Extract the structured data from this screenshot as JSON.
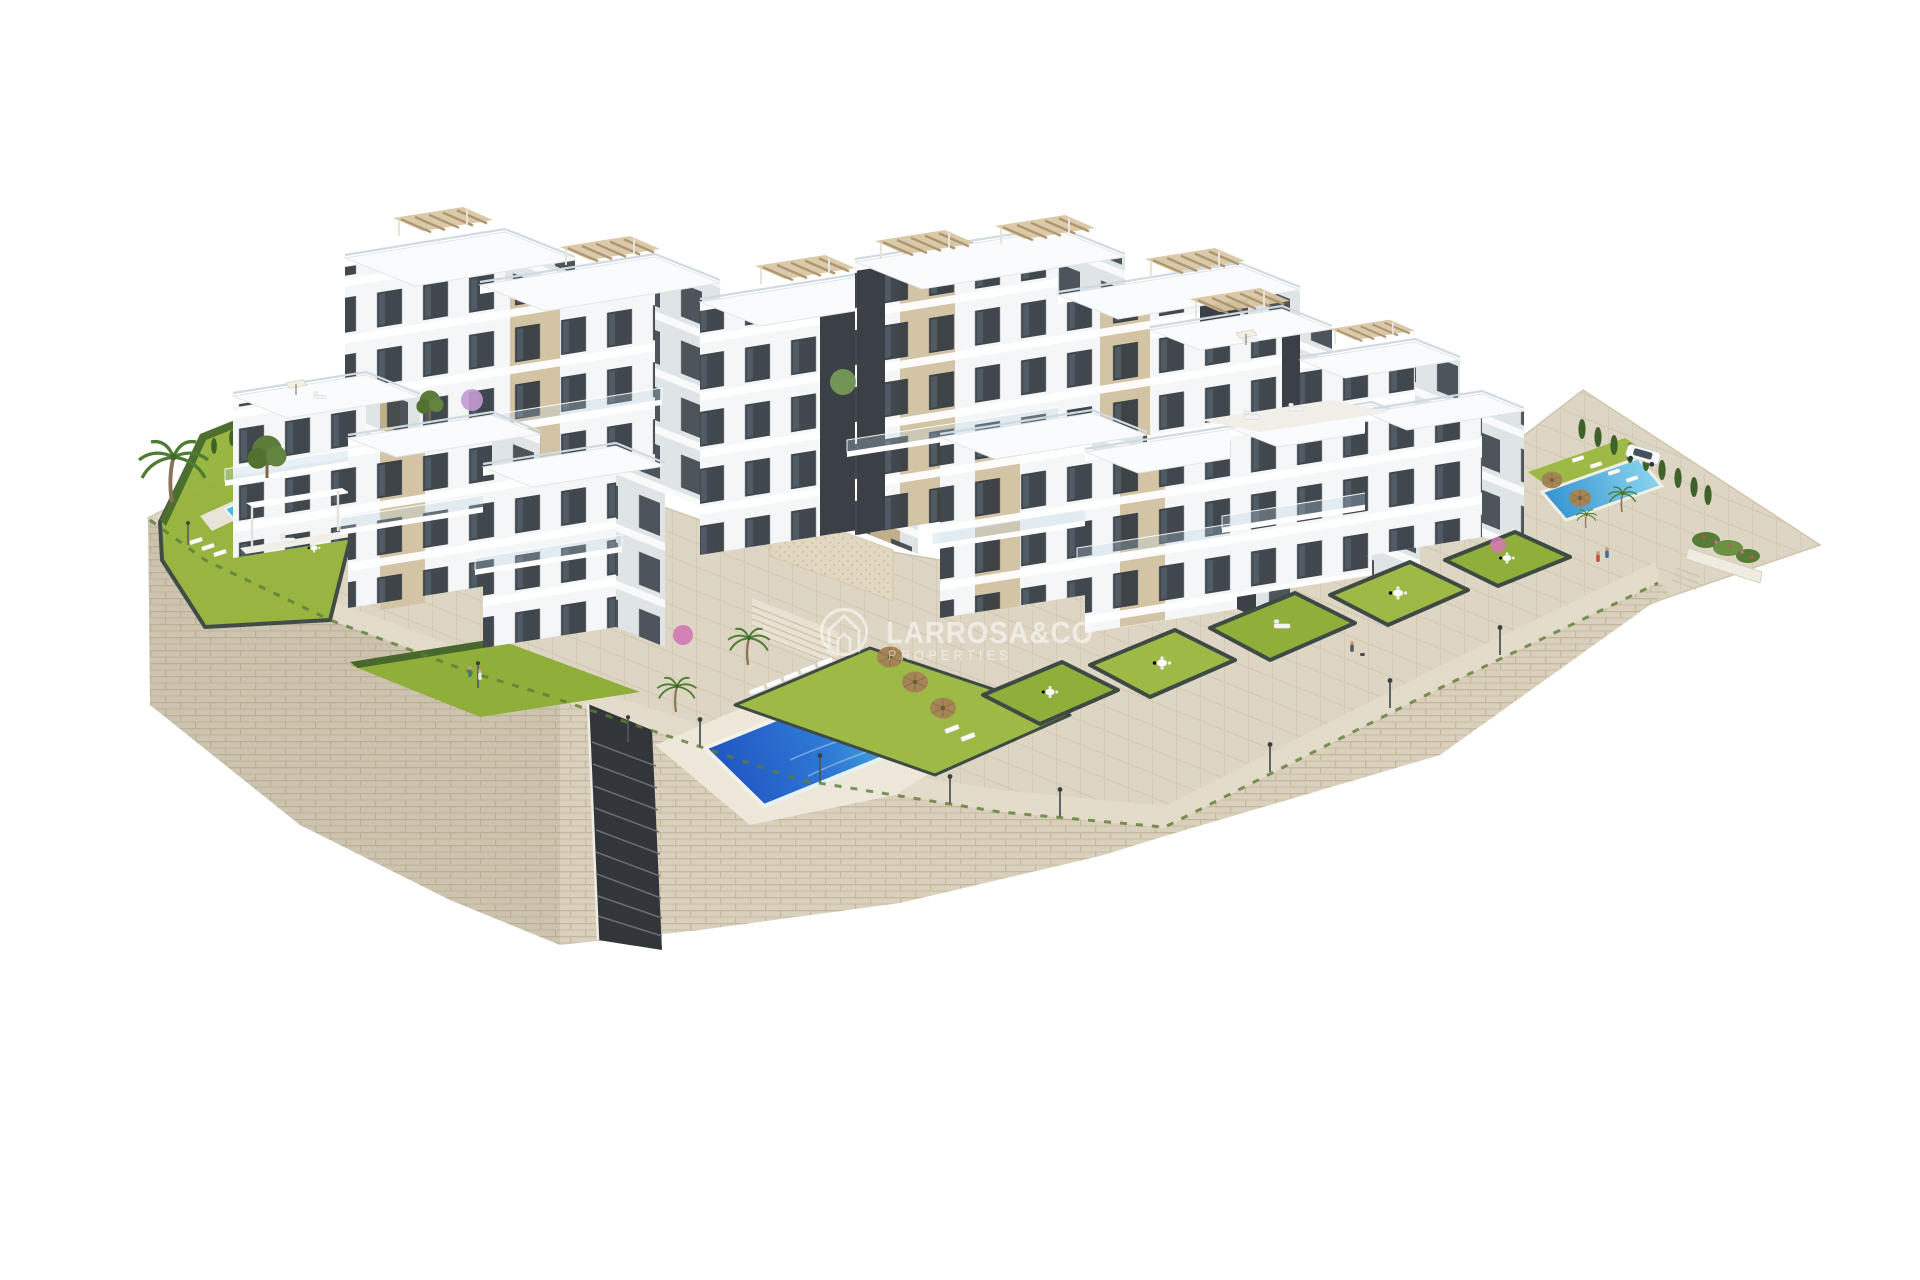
{
  "meta": {
    "description": "Aerial 3D architectural render of a hillside residential complex: white apartment blocks with tan accents and rooftop pergolas, terraced private gardens, three swimming pools, palm trees and travertine stone retaining walls on a pure white background"
  },
  "watermark": {
    "brand": "LARROSA&CO",
    "tagline": "PROPERTIES",
    "logo": "house-in-circle-icon",
    "color": "#ffffff"
  },
  "palette": {
    "background": "#ffffff",
    "building_front": "#f4f6f7",
    "building_side": "#dfe4e7",
    "roof": "#fafbfc",
    "accent_tan": "#d4c4a6",
    "accent_tan_dark": "#c2ae8b",
    "window_dark": "#31383f",
    "anthracite_core": "#3a4046",
    "stone_wall": "#d9d0bd",
    "paving": "#ded6c4",
    "grass": "#97b53f",
    "hedge": "#4c6e2f",
    "pool_deep": "#1d4fc0",
    "pool_light": "#55c4e8",
    "umbrella_straw": "#a58556"
  },
  "scene": {
    "elements": [
      "stone-retaining-wall",
      "hillside-staircase",
      "left-private-garden",
      "left-plunge-pool",
      "community-pool",
      "pool-sun-deck",
      "sun-loungers",
      "straw-umbrellas",
      "travertine-feature-wall",
      "apartment-block-row",
      "penthouse-row",
      "right-apartment-cluster",
      "front-left-villas",
      "terraced-lawns",
      "right-community-pool",
      "parked-car",
      "cypress-hedge",
      "palm-trees",
      "street-lamps",
      "pedestrians",
      "flower-planter"
    ]
  }
}
